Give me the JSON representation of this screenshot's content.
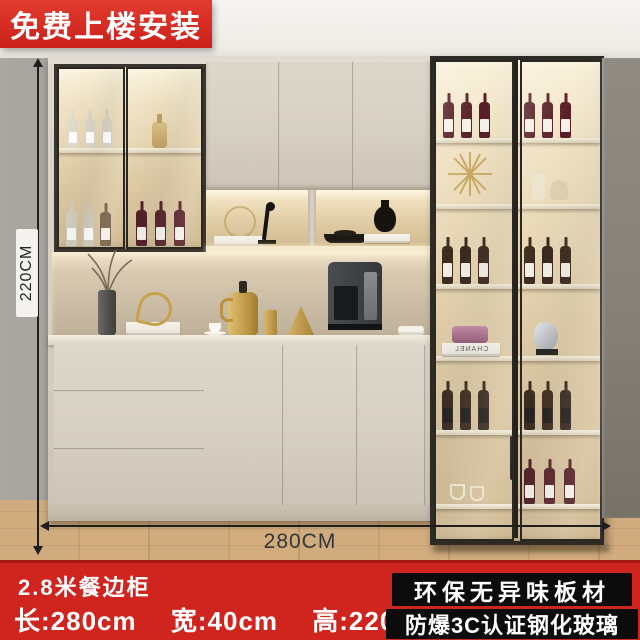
{
  "banner": {
    "label": "免费上楼安装"
  },
  "dimension_labels": {
    "height": "220CM",
    "width": "280CM"
  },
  "footer": {
    "title": "2.8米餐边柜",
    "specs": [
      "长:280cm",
      "宽:40cm",
      "高:220cm"
    ],
    "badges": [
      "环保无异味板材",
      "防爆3C认证钢化玻璃"
    ]
  },
  "decor": {
    "book_brand": "CHANEL"
  },
  "colors": {
    "banner_red": "#d3251f",
    "footer_red": "#d0241e",
    "badge_black": "#0c0c0c",
    "cabinet_beige": "#d6cfc2",
    "frame_black": "#33302b",
    "led_warm": "#f6ead0",
    "wall_gray": "#9c9891",
    "floor_wood": "#c9a478",
    "wine_red": "#4b1117",
    "whiskey_brown": "#33200f"
  }
}
